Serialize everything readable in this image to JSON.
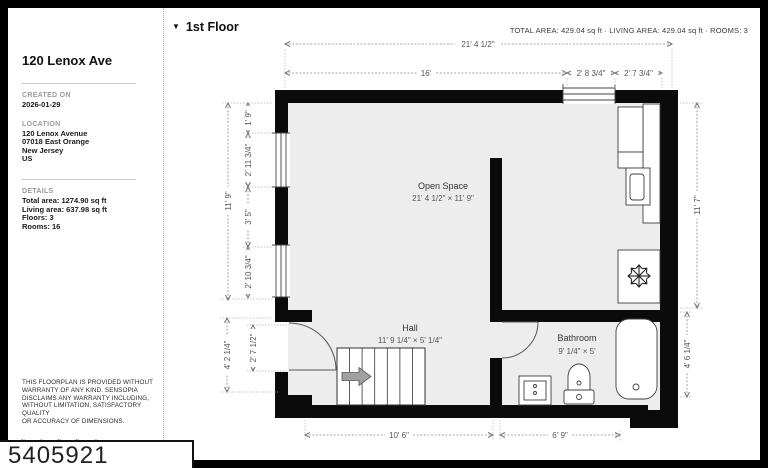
{
  "header": {
    "floor_marker": "▼",
    "floor_label": "1st Floor",
    "summary": "TOTAL AREA: 429.04 sq ft · LIVING AREA: 429.04 sq ft · ROOMS: 3"
  },
  "sidebar": {
    "title": "120 Lenox Ave",
    "created": {
      "label": "CREATED ON",
      "value": "2026-01-29"
    },
    "location": {
      "label": "LOCATION",
      "lines": [
        "120 Lenox Avenue",
        "07018 East Orange",
        "New Jersey",
        "US"
      ]
    },
    "details": {
      "label": "DETAILS",
      "lines": [
        "Total area: 1274.90 sq ft",
        "Living area: 637.98 sq ft",
        "Floors: 3",
        "Rooms: 16"
      ]
    },
    "disclaimer": [
      "THIS FLOORPLAN IS PROVIDED WITHOUT",
      "WARRANTY OF ANY KIND. SENSOPIA",
      "DISCLAIMS ANY WARRANTY INCLUDING,",
      "WITHOUT LIMITATION, SATISFACTORY QUALITY",
      "OR ACCURACY OF DIMENSIONS."
    ],
    "scale": {
      "ticks": [
        "0'",
        "1'",
        "2'",
        "3'",
        "4'"
      ],
      "ratio": "1:37"
    }
  },
  "photo_id": "5405921",
  "plan": {
    "rooms": {
      "open_space": {
        "name": "Open Space",
        "size": "21' 4 1/2\" × 11' 9\""
      },
      "hall": {
        "name": "Hall",
        "size": "11' 9 1/4\" × 5' 1/4\""
      },
      "bathroom": {
        "name": "Bathroom",
        "size": "9' 1/4\" × 5'"
      }
    },
    "dims": {
      "top_total": "21' 4 1/2\"",
      "top_left": "16'",
      "top_mid": "2' 8 3/4\"",
      "top_right": "2' 7 3/4\"",
      "left_total": "11' 9\"",
      "left_seg1": "1' 9\"",
      "left_seg2": "2' 11 3/4\"",
      "left_seg3": "3' 5\"",
      "left_seg4": "2' 10 3/4\"",
      "left_lower": "4' 2 1/4\"",
      "left_door": "2' 7 1/2\"",
      "right_upper": "11' 7\"",
      "right_lower": "4' 6 1/4\"",
      "bottom_left": "10' 6\"",
      "bottom_right": "6' 9\""
    }
  }
}
